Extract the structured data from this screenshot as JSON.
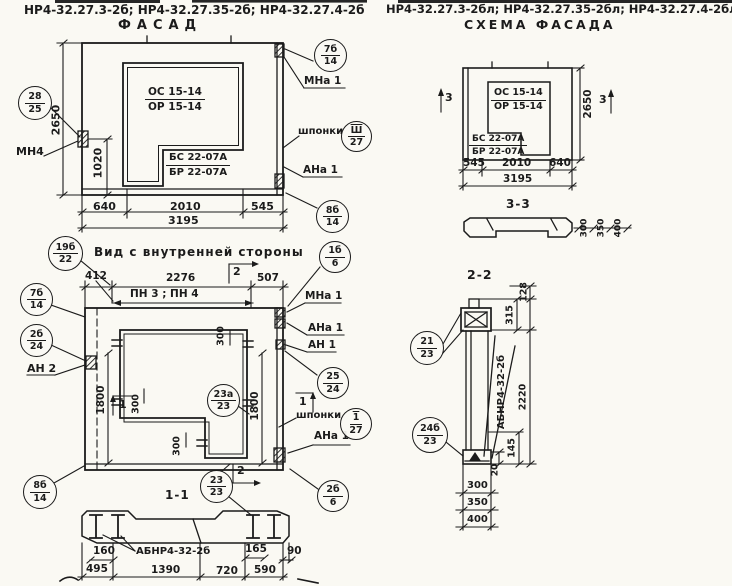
{
  "page": {
    "header_left": "НР4-32.27.3-2б; НР4-32.27.35-2б; НР4-32.27.4-2б",
    "header_right": "НР4-32.27.3-2бл; НР4-32.27.35-2бл; НР4-32.27.4-2бл",
    "ink_color": "#1b1b1b",
    "paper_color": "#faf9f3"
  },
  "facade": {
    "title": "ФАСАД",
    "window_mark_top": "ОС 15-14",
    "window_mark_bottom": "ОР 15-14",
    "door_mark_top": "БС 22-07А",
    "door_mark_bottom": "БР 22-07А",
    "dim_height": "2650",
    "dim_opening_height": "1020",
    "dim_bottom_1": "640",
    "dim_bottom_2": "2010",
    "dim_bottom_3": "545",
    "dim_total": "3195",
    "label_mn4": "МН4",
    "label_mna1": "МНа 1",
    "label_shponki": "шпонки",
    "label_ana1": "АНа 1",
    "bubble_28_25": {
      "top": "28",
      "bottom": "25"
    },
    "bubble_7b_14": {
      "top": "7б",
      "bottom": "14"
    },
    "bubble_sh_27": {
      "top": "Ш",
      "bottom": "27"
    },
    "bubble_8b_14": {
      "top": "8б",
      "bottom": "14"
    }
  },
  "scheme": {
    "title": "СХЕМА ФАСАДА",
    "window_mark_top": "ОС 15-14",
    "window_mark_bottom": "ОР 15-14",
    "door_mark_top": "БС 22-07А",
    "door_mark_bottom": "БР 22-07А",
    "dim_height": "2650",
    "dim_bottom_1": "545",
    "dim_bottom_2": "2010",
    "dim_bottom_3": "640",
    "dim_total": "3195",
    "section_mark": "3"
  },
  "section33": {
    "title": "3-3",
    "dim_1": "300",
    "dim_2": "350",
    "dim_3": "400"
  },
  "inner": {
    "title": "Вид с внутренней стороны",
    "dim_top_1": "412",
    "dim_top_2": "2276",
    "dim_top_3": "507",
    "label_pn": "ПН 3 ; ПН 4",
    "dim_left": "1800",
    "dim_right": "1800",
    "dim_300a": "300",
    "dim_300b": "300",
    "dim_300c": "300",
    "label_an2": "АН 2",
    "label_mna1": "МНа 1",
    "label_ana1_top": "АНа 1",
    "label_an1": "АН 1",
    "label_shponki": "шпонки",
    "label_ana1_bottom": "АНа 1",
    "section_mark_1": "1",
    "section_mark_2": "2",
    "bubble_19b_22": {
      "top": "19б",
      "bottom": "22"
    },
    "bubble_7b_14": {
      "top": "7б",
      "bottom": "14"
    },
    "bubble_2b_24": {
      "top": "2б",
      "bottom": "24"
    },
    "bubble_1b_6": {
      "top": "1б",
      "bottom": "6"
    },
    "bubble_25_24": {
      "top": "25",
      "bottom": "24"
    },
    "bubble_1_27": {
      "top": "1",
      "bottom": "27"
    },
    "bubble_23a_23": {
      "top": "23а",
      "bottom": "23"
    },
    "bubble_8b_14": {
      "top": "8б",
      "bottom": "14"
    },
    "bubble_23_23": {
      "top": "23",
      "bottom": "23"
    },
    "bubble_2b_6": {
      "top": "2б",
      "bottom": "6"
    }
  },
  "section11": {
    "title": "1-1",
    "label_abnr": "АБНР4-32-2б",
    "dim_160": "160",
    "dim_165": "165",
    "dim_90": "90",
    "dim_495": "495",
    "dim_1390": "1390",
    "dim_720": "720",
    "dim_590": "590"
  },
  "section22": {
    "title": "2-2",
    "label_abnr": "АБНР4-32-2б",
    "dim_128": "128",
    "dim_315": "315",
    "dim_2220": "2220",
    "dim_145": "145",
    "dim_20": "20",
    "dim_300": "300",
    "dim_350": "350",
    "dim_400": "400",
    "bubble_21_23": {
      "top": "21",
      "bottom": "23"
    },
    "bubble_24b_23": {
      "top": "24б",
      "bottom": "23"
    }
  }
}
